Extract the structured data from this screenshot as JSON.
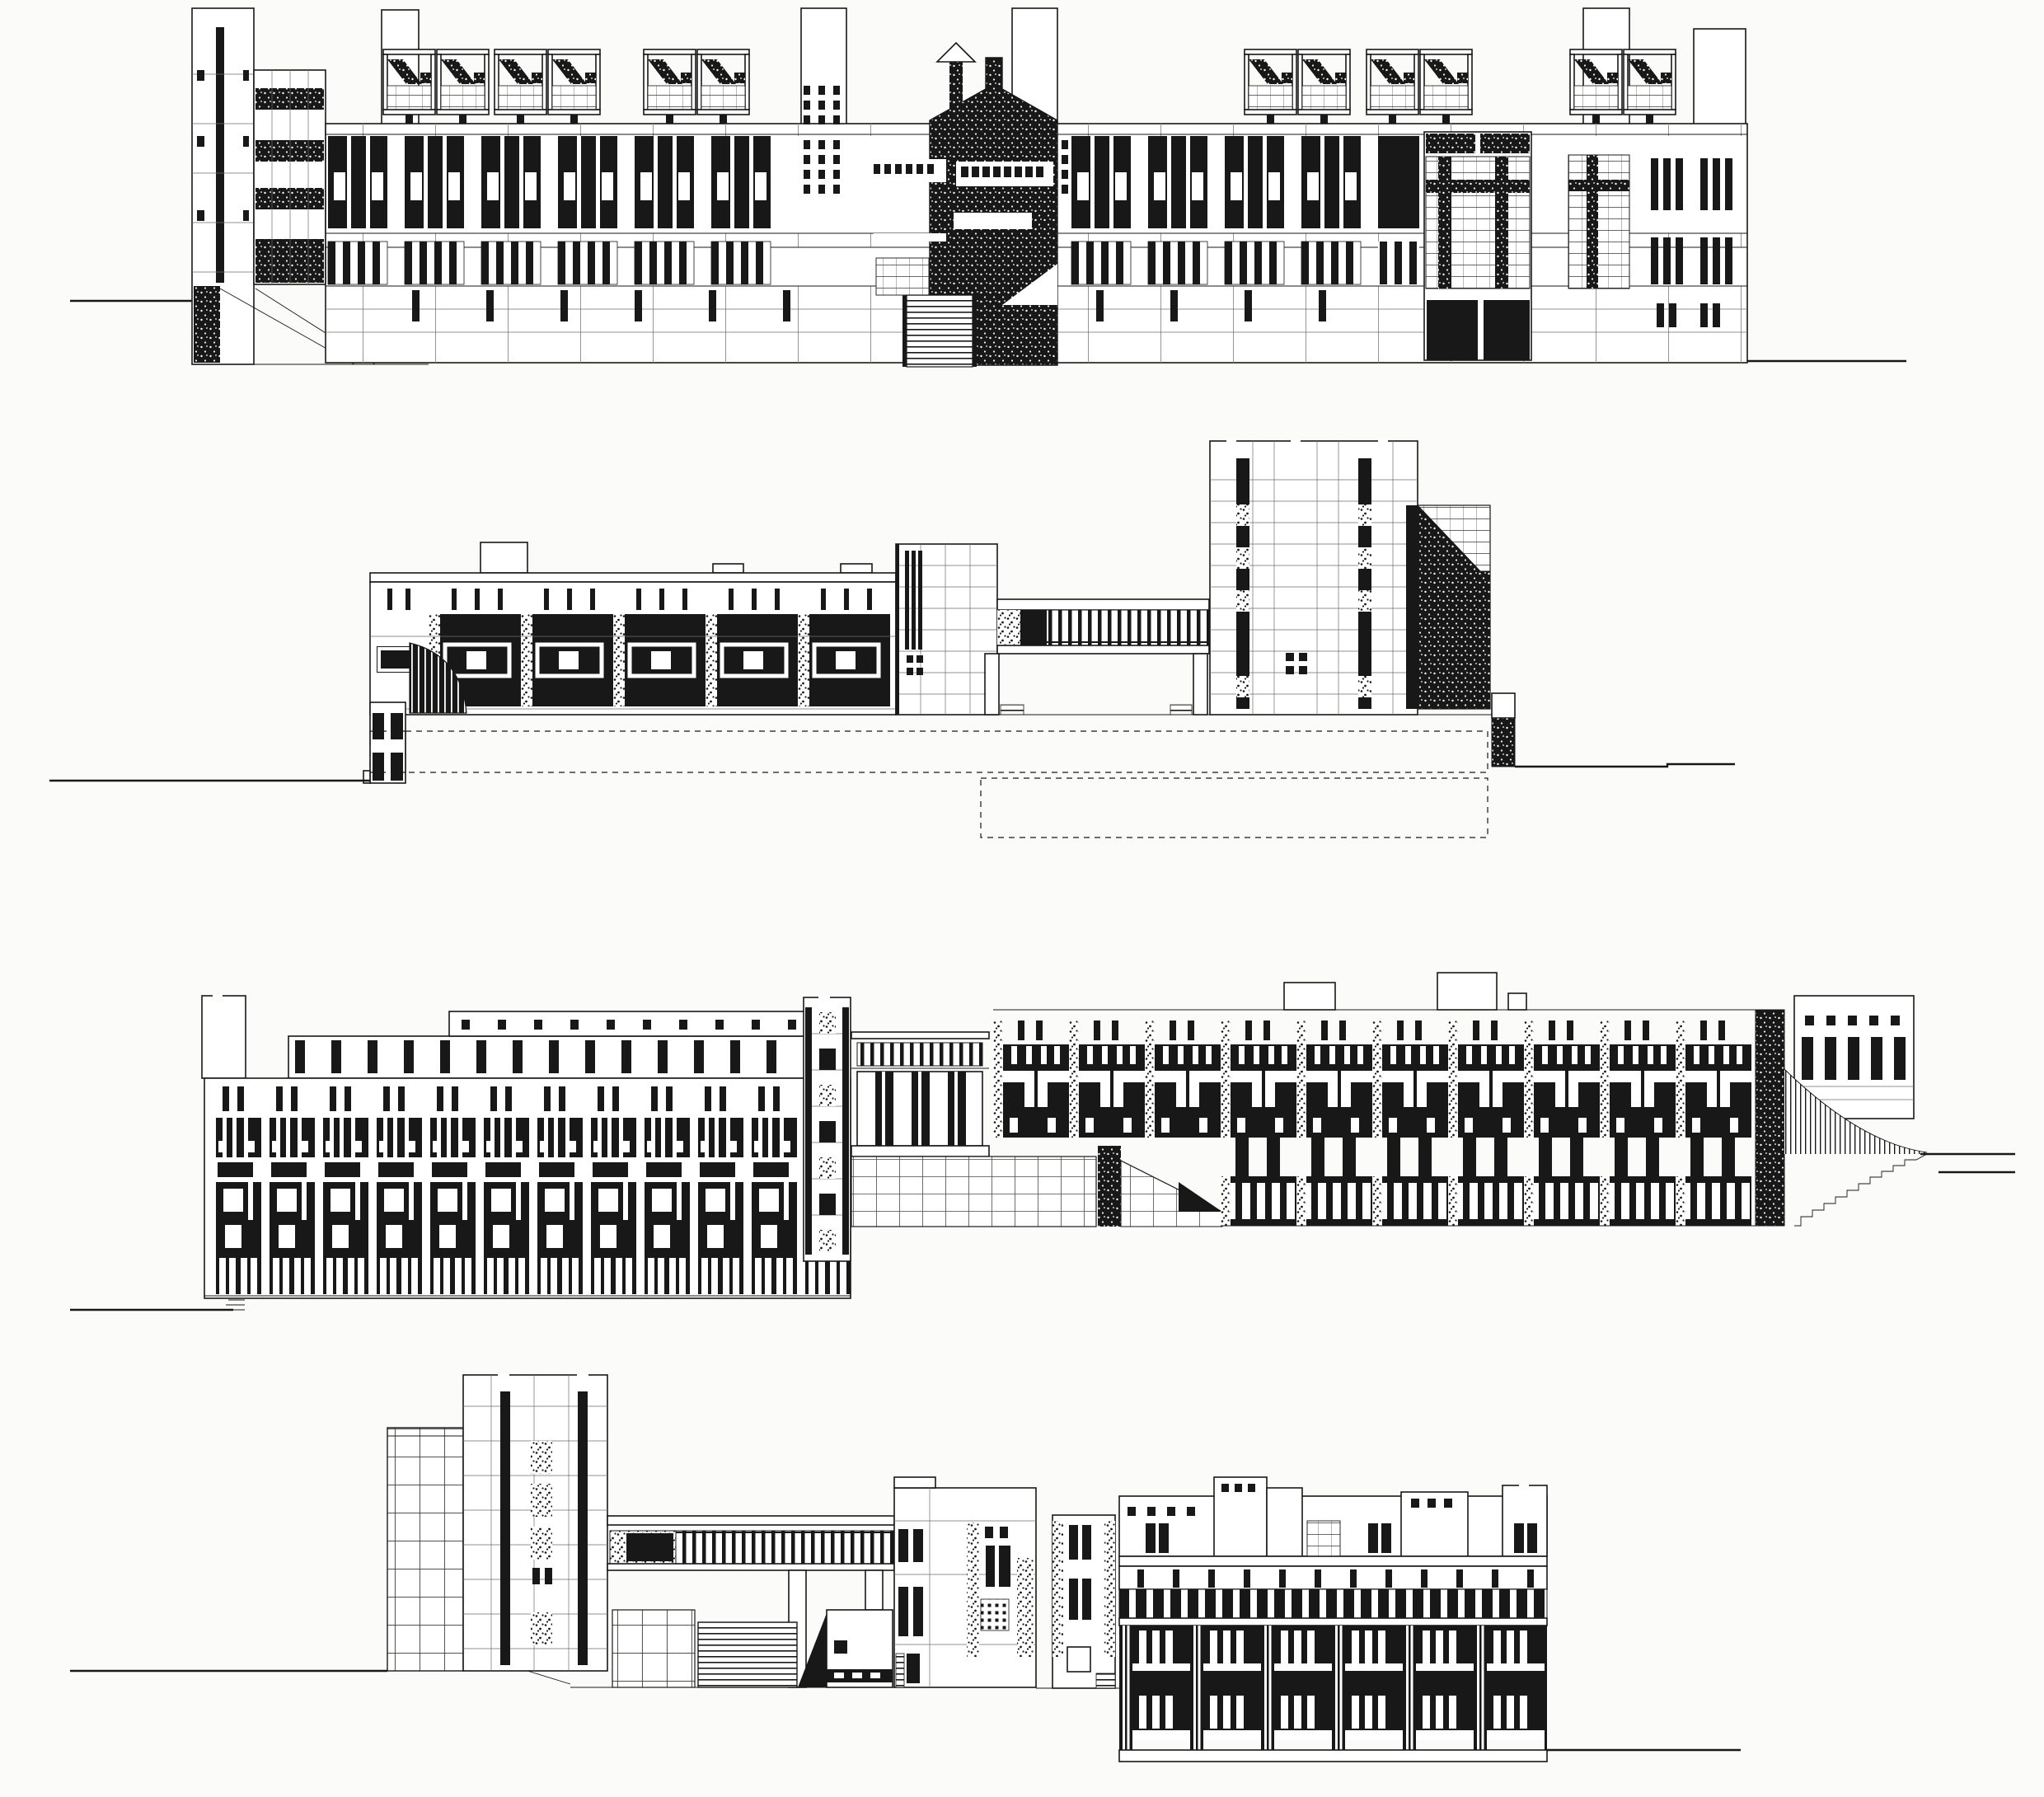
{
  "document": {
    "kind": "architectural elevation sheet",
    "medium": "black ink line drawing on white paper",
    "drawing_count": 4,
    "visible_text": ""
  },
  "palette": {
    "paper": "#fbfbf9",
    "ink": "#181818",
    "halftone": "#555555"
  },
  "drawings": [
    {
      "id": "elevation-1",
      "aria": "Top elevation: long symmetrical four-storey street facade with rooftop pavilions and canopies, dark hatched gabled entrance tower with dentil band and entry stair, flanking roof stacks, gridded corner window block and striped end bay"
    },
    {
      "id": "elevation-2",
      "aria": "Second elevation: low left wing with framed windows and curved glazed corner, taller gridded mid block, long glazed bridge on slender piers, battlemented tower with hatched hillside wedge at right, dashed hidden basement outlines below grade"
    },
    {
      "id": "elevation-3",
      "aria": "Third elevation: left four-storey block with dense dark window grid and penthouse band, central campanile and colonnaded portico pavilion with stepped ramp, right block of repeated window bays on ground rising to a hatched slope and small upper pavilion"
    },
    {
      "id": "elevation-4",
      "aria": "Bottom elevation: left gridded slab and battlemented tower, glazed bridge over a broad exterior stair and small pavilions, central crenellated pavilion, right residential block with two dark window storeys reaching down to a lower street level"
    }
  ]
}
